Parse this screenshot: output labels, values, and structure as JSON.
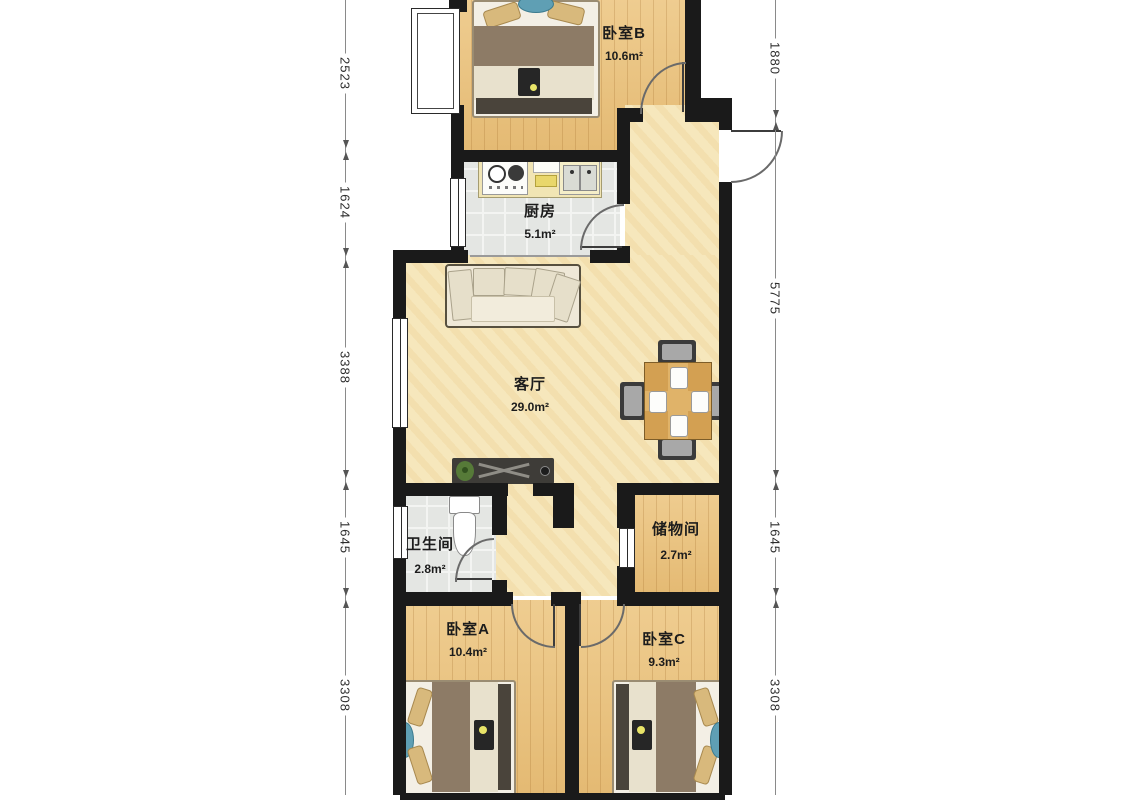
{
  "palette": {
    "wall": "#1a1a1a",
    "wood_floor": "#ecc47d",
    "marble_floor": "#f6e7bc",
    "tile_floor": "#e4e6e3",
    "table_wood": "#d3a052",
    "blanket": "#8d7b66",
    "pillow": "#d8b97c",
    "accent_blue": "#5f9fb4",
    "dim_text": "#2e2e2e"
  },
  "watermark": {
    "latin": "LIANJIA",
    "suffix": "com"
  },
  "rooms": [
    {
      "id": "bedroom-b",
      "name": "卧室B",
      "area": "10.6m²",
      "cx": 624,
      "name_y": 22,
      "area_y": 45
    },
    {
      "id": "kitchen",
      "name": "厨房",
      "area": "5.1m²",
      "cx": 540,
      "name_y": 200,
      "area_y": 223
    },
    {
      "id": "living-room",
      "name": "客厅",
      "area": "29.0m²",
      "cx": 530,
      "name_y": 373,
      "area_y": 396
    },
    {
      "id": "bathroom",
      "name": "卫生间",
      "area": "2.8m²",
      "cx": 430,
      "name_y": 533,
      "area_y": 558
    },
    {
      "id": "storage",
      "name": "储物间",
      "area": "2.7m²",
      "cx": 676,
      "name_y": 518,
      "area_y": 544
    },
    {
      "id": "bedroom-a",
      "name": "卧室A",
      "area": "10.4m²",
      "cx": 468,
      "name_y": 618,
      "area_y": 641
    },
    {
      "id": "bedroom-c",
      "name": "卧室C",
      "area": "9.3m²",
      "cx": 664,
      "name_y": 628,
      "area_y": 651
    }
  ],
  "dimensions": {
    "left": {
      "x": 345,
      "segments": [
        {
          "value": "2523",
          "y1": 0,
          "y2": 150,
          "arrow_top": false,
          "arrow_bottom": true
        },
        {
          "value": "1624",
          "y1": 150,
          "y2": 258,
          "arrow_top": true,
          "arrow_bottom": true
        },
        {
          "value": "3388",
          "y1": 258,
          "y2": 480,
          "arrow_top": true,
          "arrow_bottom": true
        },
        {
          "value": "1645",
          "y1": 480,
          "y2": 598,
          "arrow_top": true,
          "arrow_bottom": true
        },
        {
          "value": "3308",
          "y1": 598,
          "y2": 795,
          "arrow_top": true,
          "arrow_bottom": false
        }
      ]
    },
    "right": {
      "x": 775,
      "segments": [
        {
          "value": "1880",
          "y1": 0,
          "y2": 120,
          "arrow_top": false,
          "arrow_bottom": true
        },
        {
          "value": "5775",
          "y1": 120,
          "y2": 480,
          "arrow_top": true,
          "arrow_bottom": true
        },
        {
          "value": "1645",
          "y1": 480,
          "y2": 598,
          "arrow_top": true,
          "arrow_bottom": true
        },
        {
          "value": "3308",
          "y1": 598,
          "y2": 795,
          "arrow_top": true,
          "arrow_bottom": false
        }
      ]
    }
  }
}
